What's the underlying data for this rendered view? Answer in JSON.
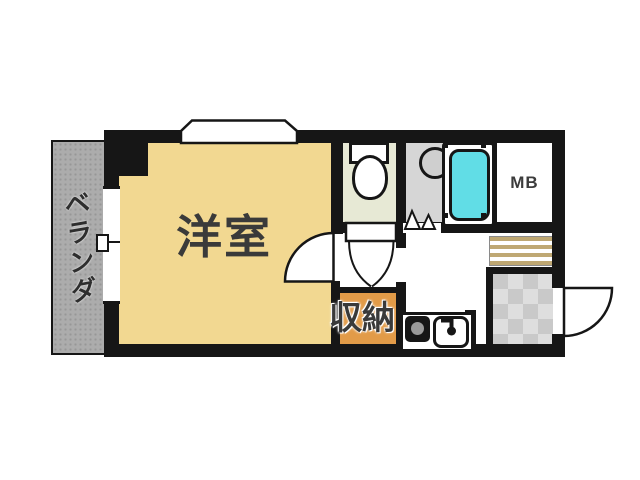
{
  "floor_plan": {
    "veranda_label": "ベランダ",
    "room_label": "洋室",
    "storage_label": "収納",
    "meter_box_label": "MB"
  },
  "colors": {
    "wall": "#161616",
    "room_floor": "#f2d891",
    "toilet_floor": "#e7e9d5",
    "washroom_floor": "#d6d6d6",
    "bathtub": "#61dde6",
    "storage_floor": "#e29b48",
    "veranda": "#acacac",
    "stripe_tan": "#bfa873",
    "tile_light": "#dedede",
    "tile_dark": "#c9c9c9"
  }
}
